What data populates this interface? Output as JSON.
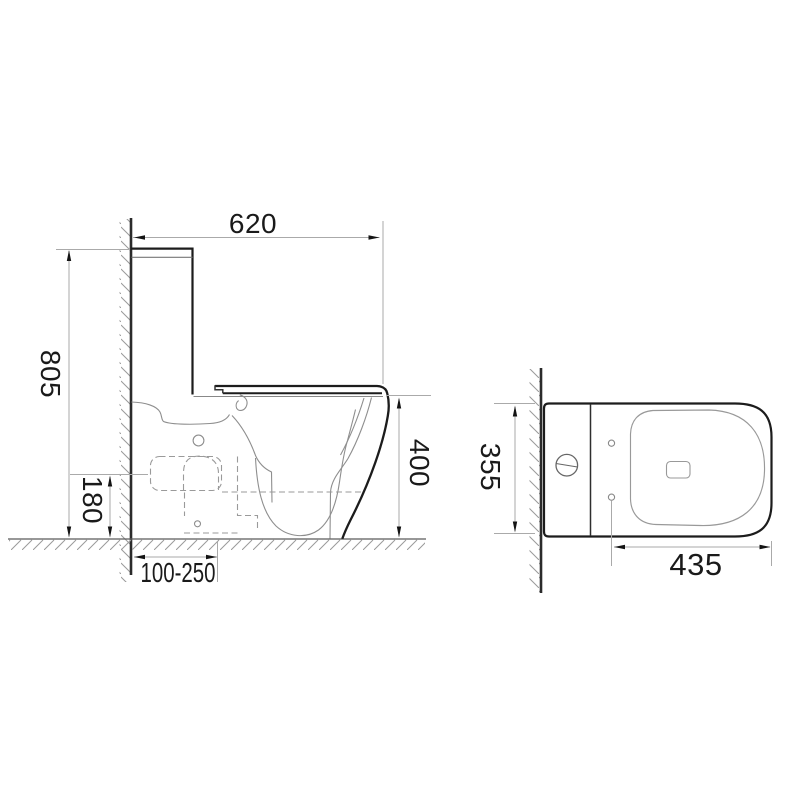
{
  "drawing": {
    "type": "technical-dimension-drawing",
    "views": {
      "left": "side-elevation",
      "right": "top-plan"
    },
    "side_view": {
      "dimensions": [
        {
          "id": "overall-depth",
          "value": "620",
          "orientation": "horizontal"
        },
        {
          "id": "overall-height",
          "value": "805",
          "orientation": "vertical"
        },
        {
          "id": "outlet-height",
          "value": "180",
          "orientation": "vertical"
        },
        {
          "id": "bowl-height",
          "value": "400",
          "orientation": "vertical"
        },
        {
          "id": "rough-in-range",
          "value": "100-250",
          "orientation": "horizontal"
        }
      ]
    },
    "top_view": {
      "dimensions": [
        {
          "id": "overall-width",
          "value": "355",
          "orientation": "vertical"
        },
        {
          "id": "bowl-length",
          "value": "435",
          "orientation": "horizontal"
        }
      ]
    },
    "colors": {
      "outline": "#1c1c1c",
      "thin_line": "#8e8e8e",
      "dimension_line": "#aaaaaa",
      "background": "#ffffff"
    }
  }
}
